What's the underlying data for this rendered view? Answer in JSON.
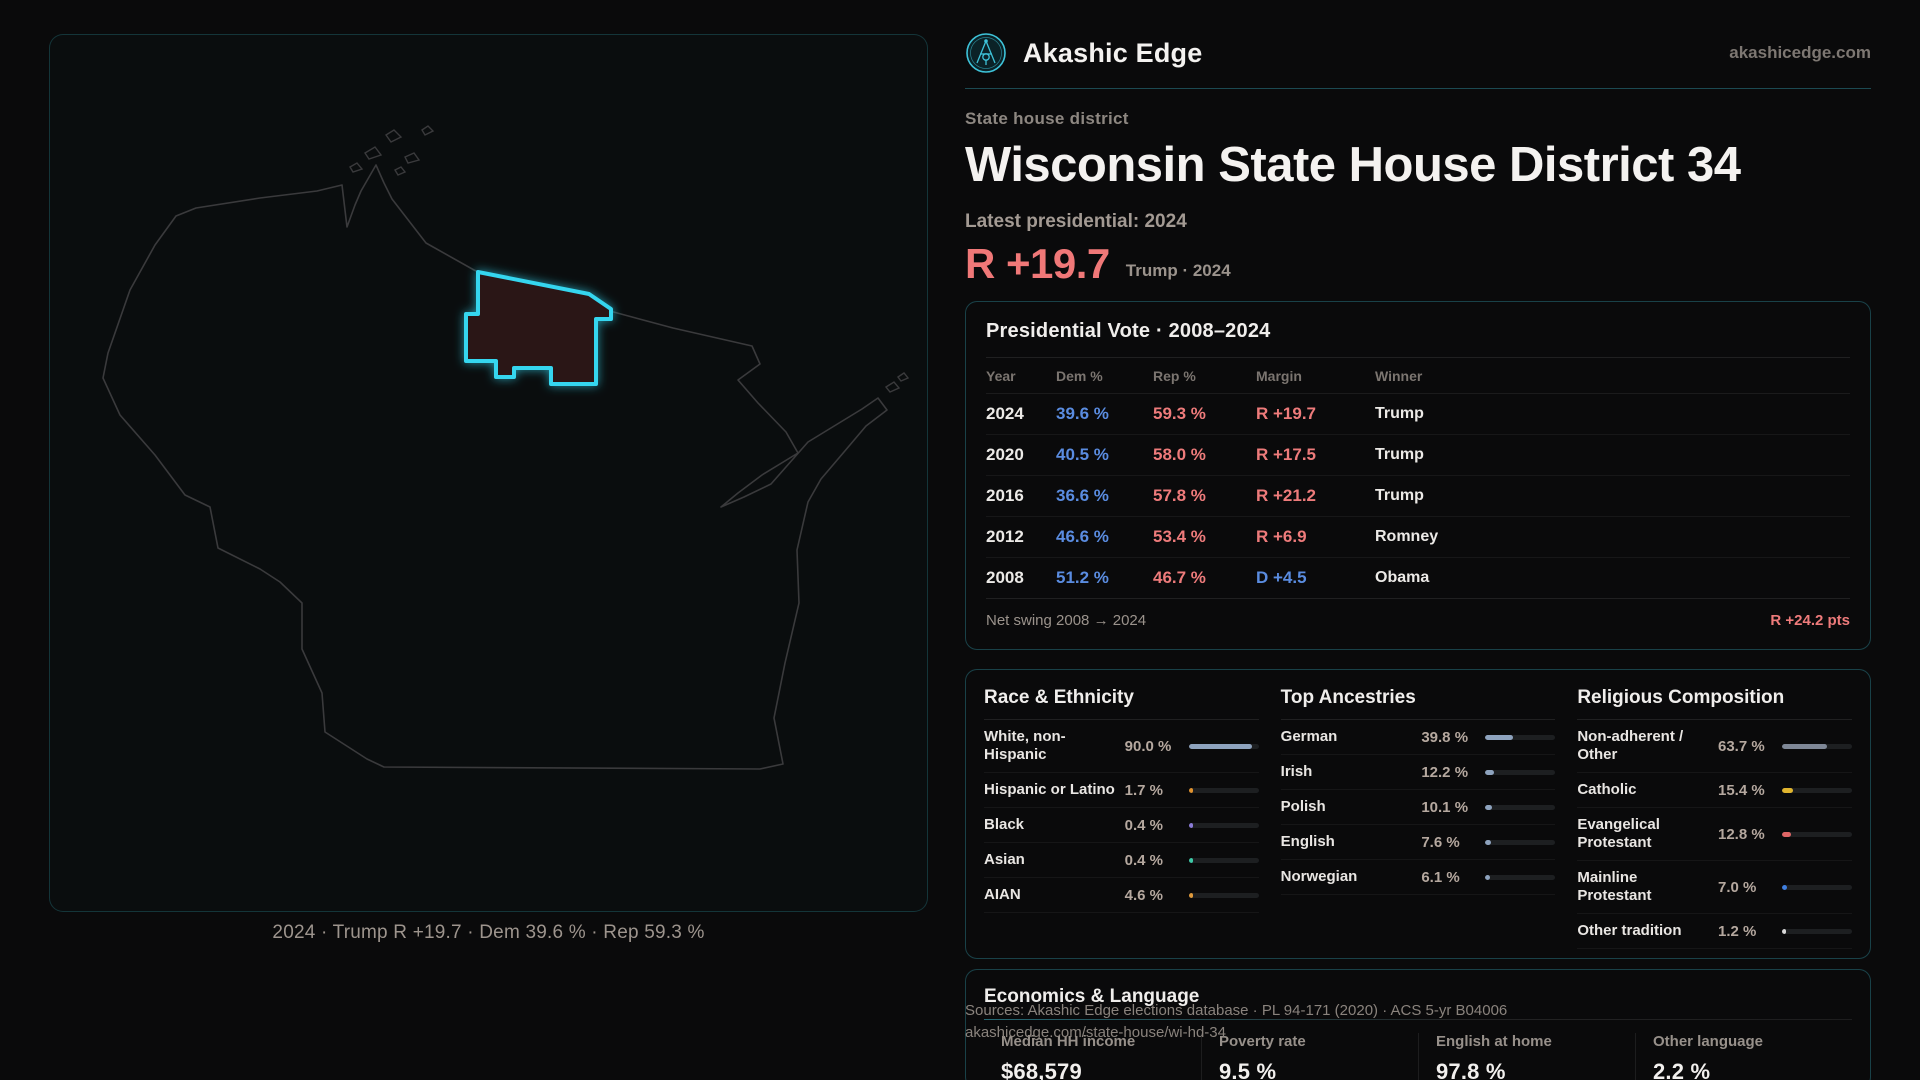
{
  "brand": {
    "name": "Akashic Edge",
    "domain": "akashicedge.com",
    "logo_icon": "compass-emblem-icon",
    "accent_teal": "#3ec3d9"
  },
  "page": {
    "kicker": "State house district",
    "title": "Wisconsin State House District 34",
    "latest_label": "Latest presidential: 2024",
    "headline_margin": "R +19.7",
    "headline_context": "Trump · 2024",
    "rep_color": "#ee7b7b",
    "dem_color": "#5a8ce0"
  },
  "map": {
    "caption": "2024 · Trump R +19.7 · Dem 39.6 % · Rep 59.3 %",
    "state": "Wisconsin",
    "district_fill": "#2a1416",
    "district_stroke": "#35d6ef",
    "outline_color": "#3a3a3c"
  },
  "vote_table": {
    "title": "Presidential Vote · 2008–2024",
    "columns": [
      "Year",
      "Dem %",
      "Rep %",
      "Margin",
      "Winner"
    ],
    "rows": [
      {
        "year": "2024",
        "dem": "39.6 %",
        "rep": "59.3 %",
        "margin": "R +19.7",
        "winner": "Trump"
      },
      {
        "year": "2020",
        "dem": "40.5 %",
        "rep": "58.0 %",
        "margin": "R +17.5",
        "winner": "Trump"
      },
      {
        "year": "2016",
        "dem": "36.6 %",
        "rep": "57.8 %",
        "margin": "R +21.2",
        "winner": "Trump"
      },
      {
        "year": "2012",
        "dem": "46.6 %",
        "rep": "53.4 %",
        "margin": "R +6.9",
        "winner": "Romney"
      },
      {
        "year": "2008",
        "dem": "51.2 %",
        "rep": "46.7 %",
        "margin": "D +4.5",
        "winner": "Obama"
      }
    ],
    "net_swing_label": "Net swing 2008 → 2024",
    "net_swing_value": "R +24.2 pts"
  },
  "race": {
    "title": "Race & Ethnicity",
    "rows": [
      {
        "label": "White, non-Hispanic",
        "value": "90.0 %",
        "pct": 90.0,
        "color": "#8ea3be"
      },
      {
        "label": "Hispanic or Latino",
        "value": "1.7 %",
        "pct": 1.7,
        "color": "#e0922f"
      },
      {
        "label": "Black",
        "value": "0.4 %",
        "pct": 0.4,
        "color": "#8b7cd8"
      },
      {
        "label": "Asian",
        "value": "0.4 %",
        "pct": 0.4,
        "color": "#3ec9a7"
      },
      {
        "label": "AIAN",
        "value": "4.6 %",
        "pct": 4.6,
        "color": "#e09a3c"
      }
    ]
  },
  "ancestries": {
    "title": "Top Ancestries",
    "rows": [
      {
        "label": "German",
        "value": "39.8 %",
        "pct": 39.8,
        "color": "#8ea3be"
      },
      {
        "label": "Irish",
        "value": "12.2 %",
        "pct": 12.2,
        "color": "#8ea3be"
      },
      {
        "label": "Polish",
        "value": "10.1 %",
        "pct": 10.1,
        "color": "#8ea3be"
      },
      {
        "label": "English",
        "value": "7.6 %",
        "pct": 7.6,
        "color": "#8ea3be"
      },
      {
        "label": "Norwegian",
        "value": "6.1 %",
        "pct": 6.1,
        "color": "#8ea3be"
      }
    ]
  },
  "religion": {
    "title": "Religious Composition",
    "rows": [
      {
        "label": "Non-adherent / Other",
        "value": "63.7 %",
        "pct": 63.7,
        "color": "#7e8796"
      },
      {
        "label": "Catholic",
        "value": "15.4 %",
        "pct": 15.4,
        "color": "#e0b52f"
      },
      {
        "label": "Evangelical Protestant",
        "value": "12.8 %",
        "pct": 12.8,
        "color": "#e06666"
      },
      {
        "label": "Mainline Protestant",
        "value": "7.0 %",
        "pct": 7.0,
        "color": "#3f7fe0"
      },
      {
        "label": "Other tradition",
        "value": "1.2 %",
        "pct": 1.2,
        "color": "#d9d9d9"
      }
    ]
  },
  "economics": {
    "title": "Economics & Language",
    "stats": [
      {
        "label": "Median HH income",
        "value": "$68,579"
      },
      {
        "label": "Poverty rate",
        "value": "9.5 %"
      },
      {
        "label": "English at home",
        "value": "97.8 %"
      },
      {
        "label": "Other language",
        "value": "2.2 %"
      }
    ]
  },
  "footer": {
    "line1": "Sources: Akashic Edge elections database · PL 94-171 (2020) · ACS 5-yr B04006",
    "line2": "akashicedge.com/state-house/wi-hd-34"
  }
}
